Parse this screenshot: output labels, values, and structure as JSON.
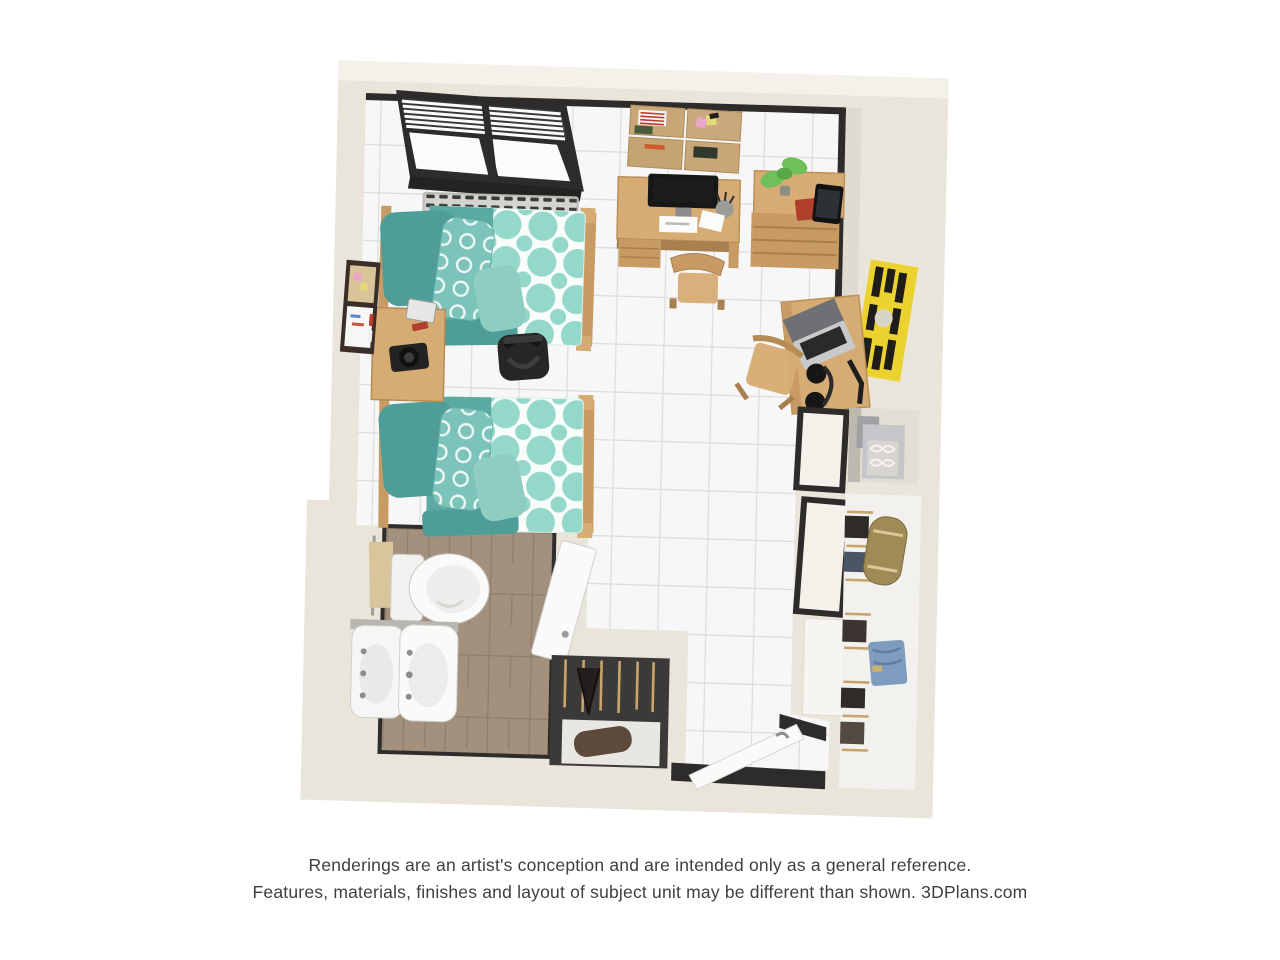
{
  "page": {
    "background": "#ffffff"
  },
  "disclaimer": {
    "line1": "Renderings are an artist's conception and are intended only as a general reference.",
    "line2": "Features, materials, finishes and layout of subject unit may be different than shown. 3DPlans.com"
  },
  "scene": {
    "title": "3D dorm studio floor plan rendering",
    "rooms": [
      "main-room",
      "bathroom",
      "closet-small",
      "entry",
      "closet-tall"
    ],
    "items": [
      "window-with-blinds",
      "radiator",
      "bed-1",
      "bed-2",
      "nightstand",
      "memo-board",
      "black-backpack",
      "cork-boards",
      "desk-with-monitor",
      "desk-chair",
      "dresser",
      "potted-plant",
      "red-book",
      "tablet",
      "yellow-poster",
      "desk-with-laptop",
      "headphones",
      "toilet",
      "double-sinks",
      "towel-bar",
      "bathroom-door",
      "hanging-clothes",
      "duffel-bag",
      "folded-jeans",
      "storage-boxes",
      "sliding-doors",
      "entry-door"
    ]
  },
  "colors": {
    "page": "#ffffff",
    "wall": "#e9e5da",
    "wall_light": "#f4f1ea",
    "wall_shadow": "#d9d4c8",
    "floor": "#f7f7f8",
    "grout": "#dcdcde",
    "bath_floor": "#a3907d",
    "bath_grout": "#8f7d6b",
    "trim_dark": "#2d2c2a",
    "wood": "#d7ac74",
    "wood_mid": "#c79b63",
    "wood_dark": "#a87f4e",
    "teal_dark": "#4f9d99",
    "teal_mid": "#5aaaa2",
    "teal_light": "#8fccc2",
    "teal_ring": "#7cc3ba",
    "mint": "#93d8c8",
    "quilt_white": "#f8fcfa",
    "closet_dark": "#3b3a38",
    "door_white": "#fafafa",
    "poster_yellow": "#ecd22f",
    "plant_green": "#6fbf5a",
    "book_red": "#b0402c",
    "denim_blue": "#7e9cbd",
    "duffel_tan": "#a08a55",
    "duffel_brown": "#5d4a3c",
    "towel_tan": "#d8c59c",
    "metal_gray": "#c8c9cb",
    "screen_black": "#1c1c1c"
  }
}
